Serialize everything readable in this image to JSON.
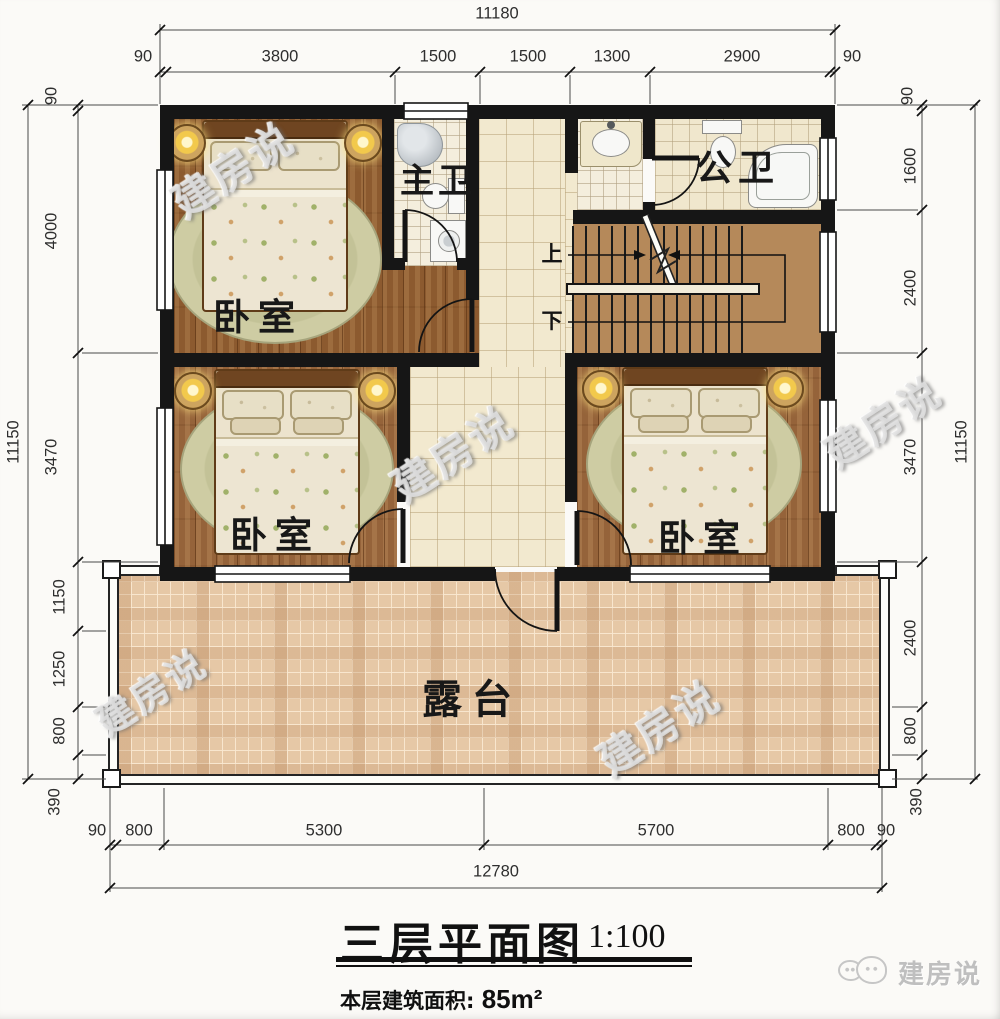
{
  "title": {
    "text": "三层平面图",
    "scale": "1:100"
  },
  "area": {
    "label": "本层建筑面积:",
    "value": "85m²"
  },
  "logo": {
    "text": "建房说"
  },
  "watermark": {
    "text": "建房说"
  },
  "rooms": {
    "bedrooms": [
      "卧室",
      "卧室",
      "卧室"
    ],
    "master_bath": "主卫",
    "public_bath": "公卫",
    "terrace": "露台",
    "stair_up": "上",
    "stair_down": "下"
  },
  "dimensions": {
    "top_total": "11180",
    "top": [
      "90",
      "3800",
      "1500",
      "1500",
      "1300",
      "2900",
      "90"
    ],
    "left_total": "11150",
    "left": [
      "90",
      "4000",
      "3470",
      "1150",
      "1250",
      "800",
      "390"
    ],
    "right_total": "11150",
    "right": [
      "90",
      "1600",
      "2400",
      "3470",
      "2400",
      "800",
      "390"
    ],
    "bottom_total": "12780",
    "bottom": [
      "90",
      "800",
      "5300",
      "5700",
      "800",
      "90"
    ]
  },
  "colors": {
    "wall": "#161616",
    "wood_floor": "#8c5a2f",
    "hall_tile": "#f2e9cf",
    "terrace_tile": "#e6c8a6",
    "stair_floor": "#b5895a"
  }
}
